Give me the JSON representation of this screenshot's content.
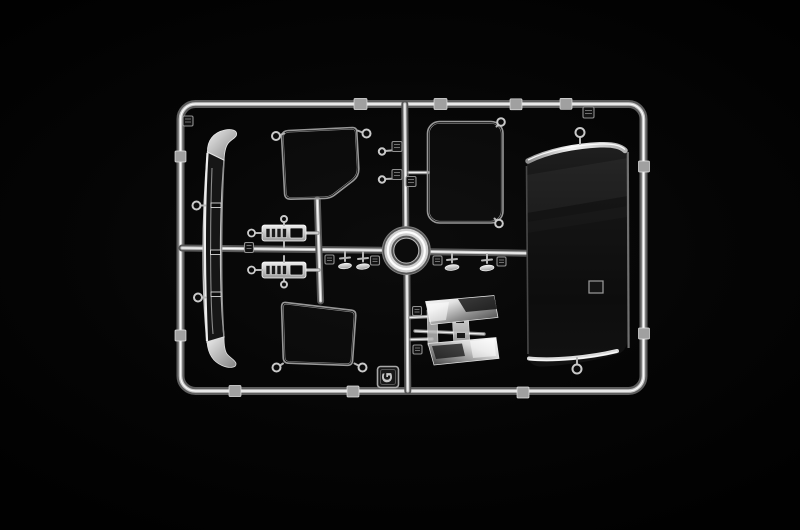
{
  "photo": {
    "subject": "Macro photograph of a clear transparent injection-moulded model-kit sprue (parts runner) on a black background",
    "background_color": "#050505",
    "plastic_colors": {
      "highlight": "#f5f5f5",
      "mid": "#b5b5b5",
      "shadow": "#4a4a4a",
      "glass_tint": "#101010",
      "chrome": "#ffffff"
    },
    "parts_visible": [
      "rectangular outer runner frame with gate tabs and number tags",
      "tall curved windscreen glazing strip (left)",
      "trapezoidal door window pane (upper middle)",
      "trapezoidal door window pane (lower middle)",
      "rounded rectangular side window pane (upper right)",
      "large smoked roof / rear panel (right)",
      "circular ring hub at the runner crossing",
      "two instrument-cluster lens strips (middle left)",
      "four small lamp lenses with part-number tags",
      "two chromed mirror blades with arm and brackets (lower right)"
    ]
  },
  "labels": {
    "sprue_letter": "G"
  }
}
